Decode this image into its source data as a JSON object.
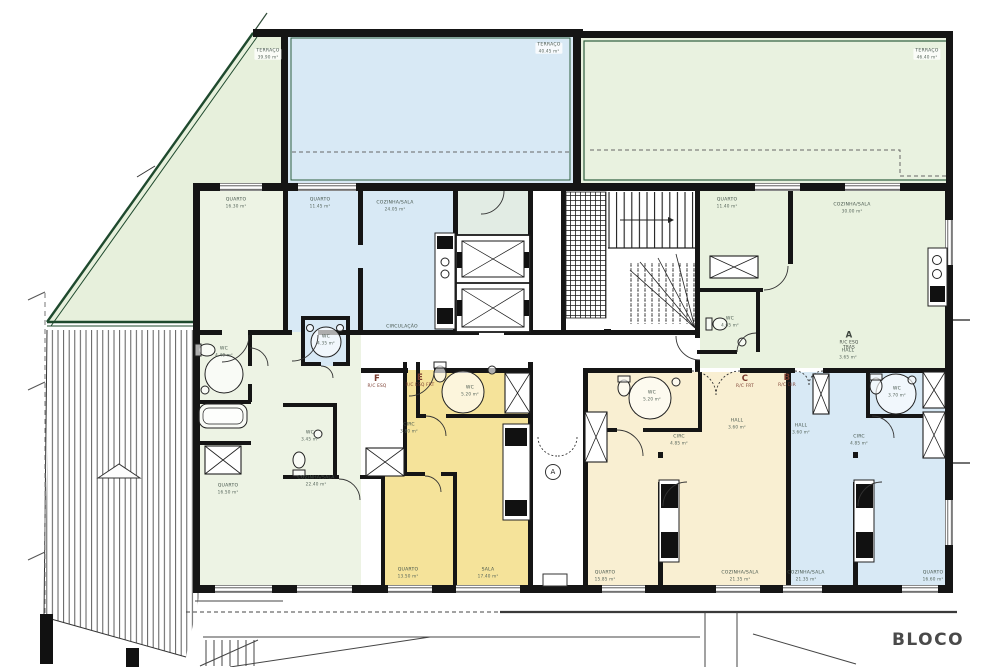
{
  "drawing_title": "BLOCO",
  "colors": {
    "terrace_green": "#e9f2e0",
    "terrace_blue": "#d8e9f5",
    "unit_yellow": "#f5e39a",
    "unit_cream": "#f9efd2",
    "unit_blue": "#d8e9f5",
    "room_green_white": "#edf3e4",
    "wall_black": "#151515",
    "green_outline": "#1f4a2e",
    "unit_letter_red": "#7a3b2e"
  },
  "plan_labels": [
    {
      "id": "terraco-left",
      "x": 268,
      "y": 54,
      "cls": "chip",
      "lines": [
        "TERRAÇO",
        "39.90 m²"
      ]
    },
    {
      "id": "terraco-mid",
      "x": 549,
      "y": 48,
      "cls": "chip",
      "lines": [
        "TERRAÇO",
        "40.45 m²"
      ]
    },
    {
      "id": "terraco-right",
      "x": 927,
      "y": 54,
      "cls": "chip",
      "lines": [
        "TERRAÇO",
        "46.40 m²"
      ]
    },
    {
      "id": "quarto-f1",
      "x": 236,
      "y": 203,
      "cls": "",
      "lines": [
        "QUARTO",
        "16.30 m²"
      ]
    },
    {
      "id": "quarto-blue",
      "x": 320,
      "y": 203,
      "cls": "",
      "lines": [
        "QUARTO",
        "11.45 m²"
      ]
    },
    {
      "id": "cozinha-sala-blue",
      "x": 395,
      "y": 206,
      "cls": "",
      "lines": [
        "COZINHA/SALA",
        "24.05 m²"
      ]
    },
    {
      "id": "quarto-a",
      "x": 727,
      "y": 203,
      "cls": "",
      "lines": [
        "QUARTO",
        "11.40 m²"
      ]
    },
    {
      "id": "cozinha-sala-a",
      "x": 852,
      "y": 208,
      "cls": "",
      "lines": [
        "COZINHA/SALA",
        "30.00 m²"
      ]
    },
    {
      "id": "wc-f1",
      "x": 224,
      "y": 352,
      "cls": "",
      "lines": [
        "WC",
        "4.40 m²"
      ]
    },
    {
      "id": "wc-blue",
      "x": 326,
      "y": 340,
      "cls": "",
      "lines": [
        "WC",
        "4.35 m²"
      ]
    },
    {
      "id": "wc-f2",
      "x": 310,
      "y": 436,
      "cls": "",
      "lines": [
        "WC",
        "3.45 m²"
      ]
    },
    {
      "id": "wc-e",
      "x": 470,
      "y": 391,
      "cls": "",
      "lines": [
        "WC",
        "5.20 m²"
      ]
    },
    {
      "id": "wc-c",
      "x": 652,
      "y": 396,
      "cls": "",
      "lines": [
        "WC",
        "5.20 m²"
      ]
    },
    {
      "id": "wc-b",
      "x": 897,
      "y": 392,
      "cls": "",
      "lines": [
        "WC",
        "3.70 m²"
      ]
    },
    {
      "id": "wc-a",
      "x": 730,
      "y": 322,
      "cls": "",
      "lines": [
        "WC",
        "4.65 m²"
      ]
    },
    {
      "id": "hall-a",
      "x": 848,
      "y": 354,
      "cls": "",
      "lines": [
        "HALL",
        "3.65 m²"
      ]
    },
    {
      "id": "hall-c",
      "x": 737,
      "y": 424,
      "cls": "",
      "lines": [
        "HALL",
        "3.60 m²"
      ]
    },
    {
      "id": "hall-b",
      "x": 801,
      "y": 429,
      "cls": "",
      "lines": [
        "HALL",
        "3.60 m²"
      ]
    },
    {
      "id": "circ-e",
      "x": 409,
      "y": 428,
      "cls": "",
      "lines": [
        "CIRC",
        "3.80 m²"
      ]
    },
    {
      "id": "circ-c",
      "x": 679,
      "y": 440,
      "cls": "",
      "lines": [
        "CIRC",
        "4.85 m²"
      ]
    },
    {
      "id": "circ-b",
      "x": 859,
      "y": 440,
      "cls": "",
      "lines": [
        "CIRC",
        "4.85 m²"
      ]
    },
    {
      "id": "circulacao",
      "x": 402,
      "y": 327,
      "cls": "",
      "lines": [
        "CIRCULAÇÃO"
      ]
    },
    {
      "id": "quarto-f2",
      "x": 228,
      "y": 489,
      "cls": "",
      "lines": [
        "QUARTO",
        "16.50 m²"
      ]
    },
    {
      "id": "cozinha-sala-f",
      "x": 316,
      "y": 481,
      "cls": "",
      "lines": [
        "COZINHA/SALA",
        "22.40 m²"
      ]
    },
    {
      "id": "quarto-e",
      "x": 408,
      "y": 573,
      "cls": "",
      "lines": [
        "QUARTO",
        "13.50 m²"
      ]
    },
    {
      "id": "sala-e",
      "x": 488,
      "y": 573,
      "cls": "",
      "lines": [
        "SALA",
        "17.40 m²"
      ]
    },
    {
      "id": "quarto-c",
      "x": 605,
      "y": 576,
      "cls": "",
      "lines": [
        "QUARTO",
        "15.85 m²"
      ]
    },
    {
      "id": "cozinha-sala-c",
      "x": 740,
      "y": 576,
      "cls": "",
      "lines": [
        "COZINHA/SALA",
        "21.35 m²"
      ]
    },
    {
      "id": "cozinha-sala-b",
      "x": 806,
      "y": 576,
      "cls": "",
      "lines": [
        "COZINHA/SALA",
        "21.35 m²"
      ]
    },
    {
      "id": "quarto-b",
      "x": 933,
      "y": 576,
      "cls": "",
      "lines": [
        "QUARTO",
        "16.60 m²"
      ]
    },
    {
      "id": "unit-a",
      "x": 849,
      "y": 341,
      "cls": "unit dark",
      "lines": [
        "A",
        "R/C ESQ",
        "TRAS"
      ]
    },
    {
      "id": "unit-b",
      "x": 787,
      "y": 381,
      "cls": "unit",
      "lines": [
        "B",
        "R/C DIR"
      ]
    },
    {
      "id": "unit-c",
      "x": 745,
      "y": 382,
      "cls": "unit",
      "lines": [
        "C",
        "R/C FRT"
      ]
    },
    {
      "id": "unit-e",
      "x": 420,
      "y": 381,
      "cls": "unit",
      "lines": [
        "E",
        "R/C ESQ FRT"
      ]
    },
    {
      "id": "unit-f",
      "x": 377,
      "y": 382,
      "cls": "unit",
      "lines": [
        "F",
        "R/C ESQ"
      ]
    },
    {
      "id": "section-marker-a",
      "x": 553,
      "y": 472,
      "cls": "marker",
      "lines": [
        "A"
      ]
    },
    {
      "id": "bloco",
      "x": 928,
      "y": 640,
      "cls": "bloco",
      "lines": [
        "BLOCO"
      ]
    }
  ]
}
